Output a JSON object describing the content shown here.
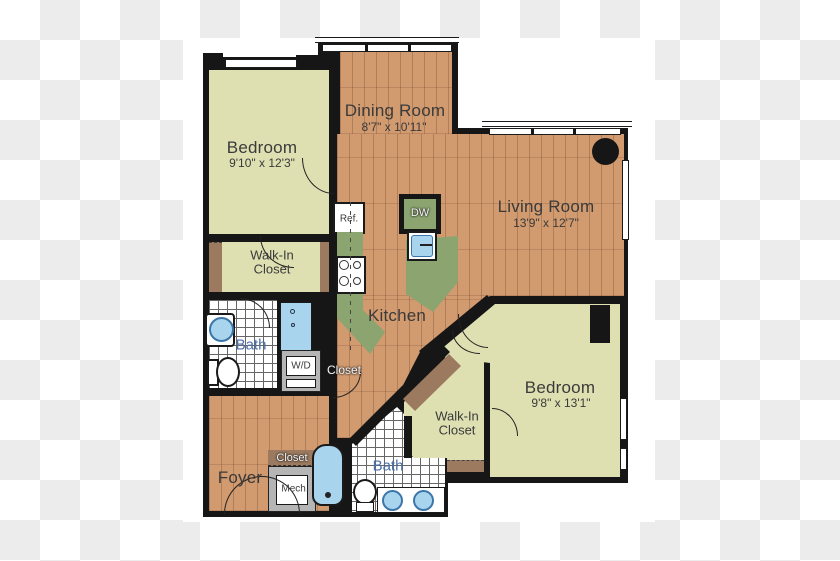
{
  "title": "Apartment floor plan",
  "colors": {
    "wood": "#d19a6f",
    "room_khaki": "#dfe0b2",
    "wall_black": "#161616",
    "counter_green": "#8ca470",
    "fixture_blue": "#a9d4ee",
    "threshold_brown": "#9b7a5f",
    "label_gray": "#3a3a3a",
    "bath_label_blue": "#4a6fa8"
  },
  "rooms": {
    "dining": {
      "label": "Dining Room",
      "dims": "8'7\" x 10'11\""
    },
    "living": {
      "label": "Living Room",
      "dims": "13'9\" x 12'7\""
    },
    "bedroom1": {
      "label": "Bedroom",
      "dims": "9'10\" x 12'3\""
    },
    "bedroom2": {
      "label": "Bedroom",
      "dims": "9'8\" x 13'1\""
    },
    "kitchen": {
      "label": "Kitchen"
    },
    "foyer": {
      "label": "Foyer"
    },
    "bath1": {
      "label": "Bath"
    },
    "bath2": {
      "label": "Bath"
    },
    "wic1": {
      "label": "Walk-In Closet"
    },
    "wic2": {
      "label": "Walk-In Closet"
    },
    "closet_kitchen": {
      "label": "Closet"
    },
    "closet_foyer": {
      "label": "Closet"
    }
  },
  "fixtures": {
    "refrigerator": "Ref.",
    "dishwasher": "DW",
    "washer_dryer": "W/D",
    "mechanical": "Mech."
  }
}
